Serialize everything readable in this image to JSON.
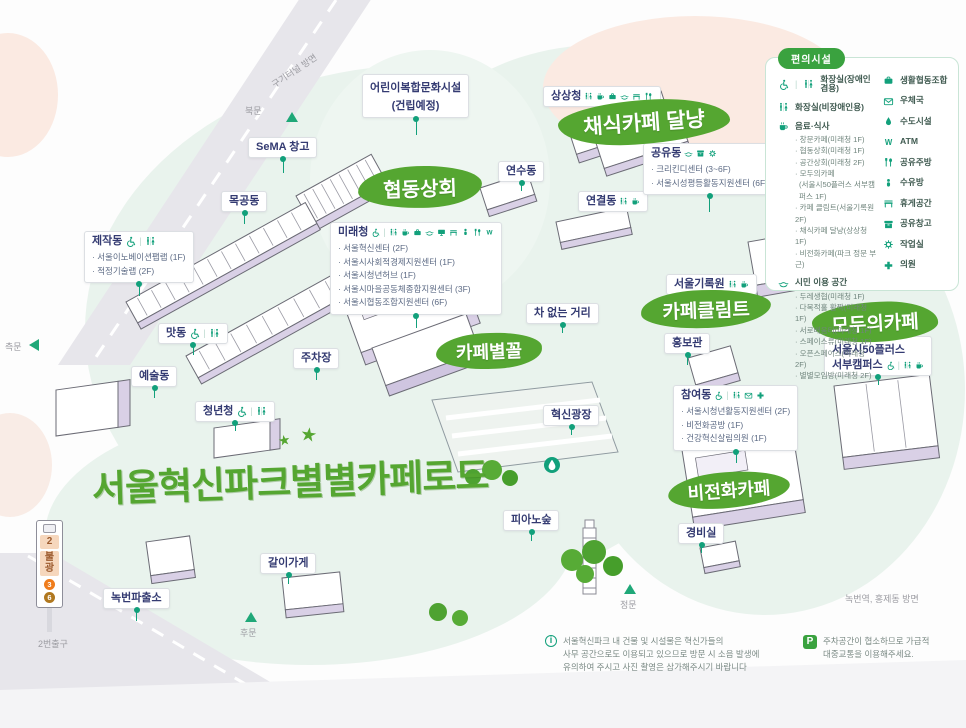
{
  "title": {
    "text": "서울혁신파크별별카페로드"
  },
  "cafes": {
    "hyupdong": "협동상회",
    "dalnyang": "채식카페 달냥",
    "klimt": "카페클림트",
    "byeolkkol": "카페별꼴",
    "moduui": "모두의카페",
    "bijeonhwa": "비전화카페"
  },
  "map": {
    "children": {
      "line1": "어린이복합문화시설",
      "line2": "(건립예정)"
    },
    "sema": {
      "name": "SeMA 창고"
    },
    "mokgong": {
      "name": "목공동"
    },
    "jejak": {
      "name": "제작동",
      "icons": [
        "wheelchair-icon",
        "restroom-icon"
      ],
      "items": [
        "· 서울이노베이션팹랩 (1F)",
        "· 적정기술랩 (2F)"
      ]
    },
    "mat": {
      "name": "맛동",
      "icons": [
        "wheelchair-icon",
        "restroom-icon"
      ]
    },
    "yesul": {
      "name": "예술동"
    },
    "cheongnyeon": {
      "name": "청년청",
      "icons": [
        "wheelchair-icon",
        "restroom-icon"
      ]
    },
    "jucha": {
      "name": "주차장"
    },
    "mirae": {
      "name": "미래청",
      "icons": [
        "wheelchair-icon",
        "restroom-icon",
        "coffee-icon",
        "bag-icon",
        "hands-icon",
        "monitor-icon",
        "bench-icon",
        "baby-icon",
        "utensils-icon",
        "atm-icon"
      ],
      "items": [
        "· 서울혁신센터 (2F)",
        "· 서울시사회적경제지원센터 (1F)",
        "· 서울시청년허브 (1F)",
        "· 서울시마을공동체종합지원센터 (3F)",
        "· 서울시협동조합지원센터 (6F)"
      ]
    },
    "sangsang": {
      "name": "상상청",
      "icons": [
        "restroom-icon",
        "coffee-icon",
        "bag-icon",
        "hands-icon",
        "bench-icon",
        "utensils-icon"
      ]
    },
    "yeonsu": {
      "name": "연수동"
    },
    "yeongyeol": {
      "name": "연결동",
      "icons": [
        "restroom-icon",
        "coffee-icon"
      ]
    },
    "gongyu": {
      "name": "공유동",
      "icons": [
        "hands-icon",
        "box-icon",
        "gear-icon"
      ],
      "items": [
        "· 크리킨디센터 (3~6F)",
        "· 서울시성평등활동지원센터 (6F)"
      ]
    },
    "archives": {
      "name": "서울기록원",
      "icons": [
        "restroom-icon",
        "coffee-icon"
      ]
    },
    "carfree": {
      "name": "차 없는 거리"
    },
    "hongbo": {
      "name": "홍보관"
    },
    "plaza": {
      "name": "혁신광장"
    },
    "chamyeo": {
      "name": "참여동",
      "icons": [
        "wheelchair-icon",
        "restroom-icon",
        "post-icon",
        "plus-icon"
      ],
      "items": [
        "· 서울시청년활동지원센터 (2F)",
        "· 비전화공방 (1F)",
        "· 건강혁신살림의원 (1F)"
      ]
    },
    "fifty": {
      "line1": "서울시50플러스",
      "line2": "서부캠퍼스",
      "icons": [
        "wheelchair-icon",
        "restroom-icon",
        "coffee-icon"
      ]
    },
    "gyeongbi": {
      "name": "경비실"
    },
    "piano": {
      "name": "피아노숲"
    },
    "gari": {
      "name": "갈이가게"
    },
    "police": {
      "name": "녹번파출소"
    }
  },
  "legend": {
    "title": "편의시설",
    "left": [
      {
        "label": "화장실(장애인 겸용)",
        "icons": [
          "wheelchair-icon",
          "restroom-icon"
        ]
      },
      {
        "label": "화장실(비장애인용)",
        "icons": [
          "restroom-icon"
        ]
      },
      {
        "label": "음료·식사",
        "icons": [
          "coffee-icon"
        ],
        "items": [
          "· 창문카페(미래청 1F)",
          "· 협동상회(미래청 1F)",
          "· 공간상회(미래청 2F)",
          "· 모두의카페",
          "(서울시50플러스 서부캠퍼스 1F)",
          "· 카페 클림트(서울기록원 2F)",
          "· 채식카페 달냥(상상청 1F)",
          "· 비전화카페(파크 정문 부근)"
        ]
      },
      {
        "label": "시민 이용 공간",
        "icons": [
          "hands-icon"
        ],
        "items": [
          "· 두레생협(미래청 1F)",
          "· 다목적홀 활짝(미래청 1F)",
          "· 서로배움터(미래청 1F)",
          "· 스페이스류(미래청 1F)",
          "· 오픈스페이스(미래청 2F)",
          "· 별별모임방(미래청 2F)"
        ]
      }
    ],
    "right": [
      {
        "label": "생활협동조합",
        "icon": "bag-icon"
      },
      {
        "label": "우체국",
        "icon": "post-icon"
      },
      {
        "label": "수도시설",
        "icon": "drop-icon"
      },
      {
        "label": "ATM",
        "icon": "atm-icon"
      },
      {
        "label": "공유주방",
        "icon": "utensils-icon"
      },
      {
        "label": "수유방",
        "icon": "baby-icon"
      },
      {
        "label": "휴게공간",
        "icon": "bench-icon"
      },
      {
        "label": "공유창고",
        "icon": "box-icon"
      },
      {
        "label": "작업실",
        "icon": "gear-icon"
      },
      {
        "label": "의원",
        "icon": "plus-icon"
      }
    ]
  },
  "directions": {
    "gukgi": "구기터널 방면",
    "north_gate": "북문",
    "side_gate": "측문",
    "rear_gate": "후문",
    "main_gate": "정문",
    "nokbeon": "녹번역, 홍제동 방면",
    "exit2": "2번출구"
  },
  "subway_sign": {
    "exit_no": "2",
    "station_c1": "불",
    "station_c2": "광",
    "line3": "3",
    "line6": "6"
  },
  "notes": {
    "info": [
      "서울혁신파크 내 건물 및 시설물은 혁신가들의",
      "사무 공간으로도 이용되고 있으므로 방문 시 소음 발생에",
      "유의하여 주시고 사진 촬영은 삼가해주시기 바랍니다"
    ],
    "parking": [
      "주차공간이 협소하므로 가급적",
      "대중교통을 이용해주세요."
    ]
  },
  "colors": {
    "teal": "#12a07b",
    "green_blob": "#55a631",
    "legend_green": "#3aa23f",
    "navy": "#343b72",
    "mint": "#e9f3ed",
    "pink": "#fbeae2",
    "lavender": "#d9d0e6"
  }
}
